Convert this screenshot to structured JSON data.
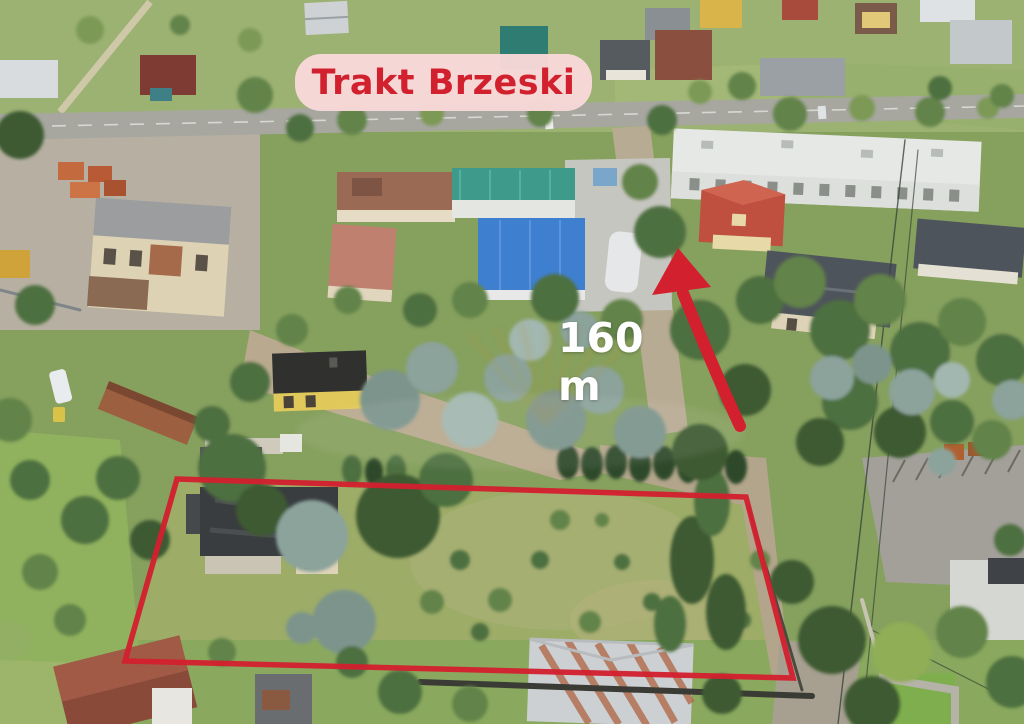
{
  "image": {
    "kind": "aerial-drone-photo",
    "description": "Aerial view of a suburban land parcel for sale, outlined in red, with distance annotation to the main road"
  },
  "annotations": {
    "road_badge": {
      "label": "Trakt Brzeski",
      "bg_color": "#f8d8d8",
      "text_color": "#d2212e"
    },
    "distance_label": {
      "text": "160 m",
      "color": "#ffffff"
    },
    "parcel_outline": {
      "points": "177,479 746,497 793,678 125,661",
      "color": "#d2202f",
      "stroke_width": "5.5"
    },
    "direction_arrow": {
      "shaft_path": "M 740 426 C 724 392 700 335 683 293",
      "head_points": "678,248 652,295 711,287",
      "color": "#d2202f"
    },
    "watermark": {
      "name": "agency-watermark",
      "ray_color": "#b8912f"
    }
  },
  "colors": {
    "annotation_red": "#d2202f",
    "badge_pink": "#f8d8d8",
    "label_white": "#ffffff"
  }
}
